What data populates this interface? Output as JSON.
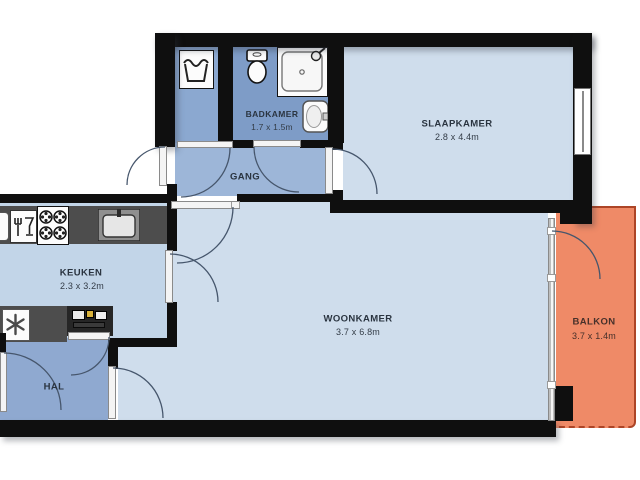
{
  "plan": {
    "type": "apartment-floor-plan",
    "rooms": {
      "badkamer": {
        "label": "BADKAMER",
        "dims": "1.7 x 1.5m"
      },
      "slaapkamer": {
        "label": "SLAAPKAMER",
        "dims": "2.8 x 4.4m"
      },
      "gang": {
        "label": "GANG",
        "dims": ""
      },
      "keuken": {
        "label": "KEUKEN",
        "dims": "2.3 x 3.2m"
      },
      "woonkamer": {
        "label": "WOONKAMER",
        "dims": "3.7 x 6.8m"
      },
      "hal": {
        "label": "HAL",
        "dims": ""
      },
      "balkon": {
        "label": "BALKON",
        "dims": "3.7 x 1.4m"
      }
    },
    "fixtures": [
      "washing-machine-icon",
      "toilet-icon",
      "shower-icon",
      "bathroom-sink-icon",
      "dishwasher-icon",
      "stove-icon",
      "kitchen-sink-icon",
      "freezer-icon",
      "electrical-panel-icon",
      "window-icon",
      "door-swing-arcs"
    ],
    "colors": {
      "wall": "#0f0f0f",
      "room_light_blue": "#cfddec",
      "kitchen_blue": "#c2d5e8",
      "corridor_blue": "#9db6d8",
      "hall_blue": "#8fa9d0",
      "bathroom_blue": "#7e9cc7",
      "laundry_blue": "#8ba8d0",
      "balcony_orange": "#ef8a67",
      "balcony_border": "#ad4527",
      "counter_gray": "#4d4d4d",
      "label_text": "#2a3440",
      "balcony_text": "#46302a"
    }
  }
}
